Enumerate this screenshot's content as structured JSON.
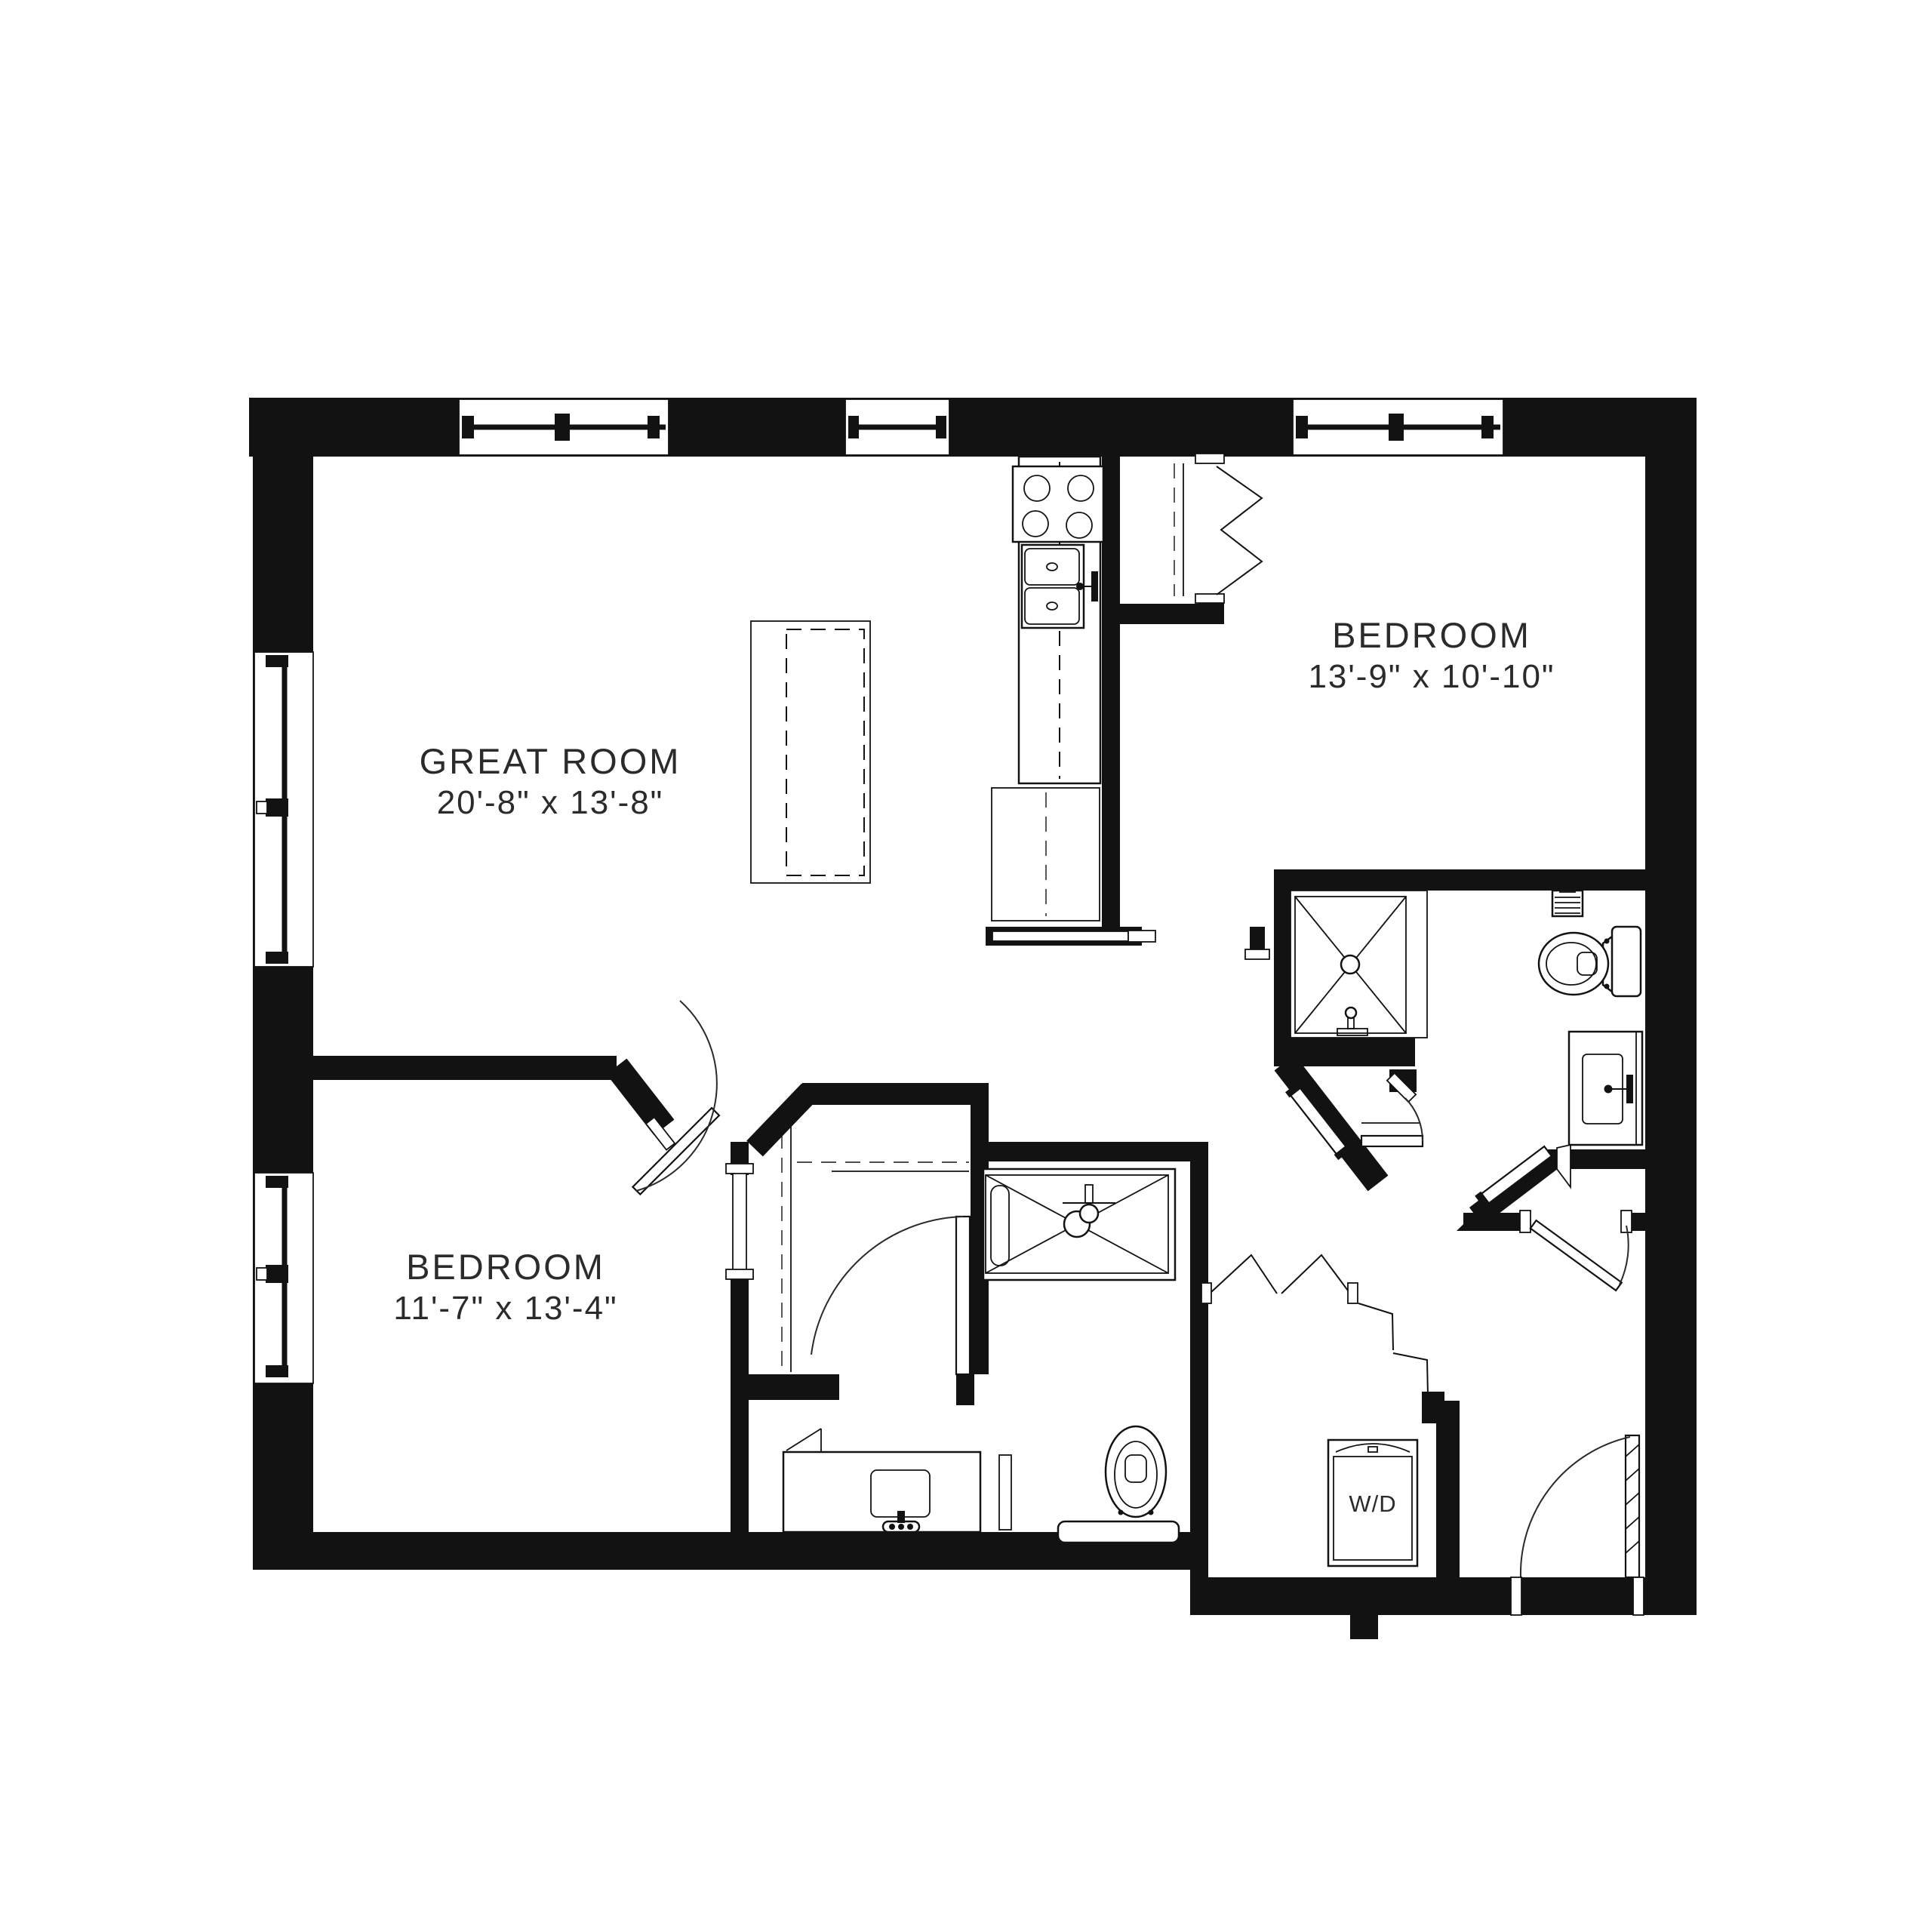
{
  "document": {
    "type": "apartment floor plan",
    "style": "black and white architectural drawing",
    "background_color": "#ffffff",
    "wall_color": "#121212",
    "line_color": "#2a2a2a",
    "text_color": "#2b2b2b"
  },
  "labels": {
    "great_room": {
      "name": "GREAT ROOM",
      "dims": "20'-8\" x 13'-8\""
    },
    "bedroom_right": {
      "name": "BEDROOM",
      "dims": "13'-9\" x 10'-10\""
    },
    "bedroom_left": {
      "name": "BEDROOM",
      "dims": "11'-7\" x 13'-4\""
    },
    "laundry": {
      "name": "W/D"
    }
  },
  "rooms": [
    {
      "label": "GREAT ROOM",
      "dimensions": "20'-8\" x 13'-8\"",
      "position": "top-left"
    },
    {
      "label": "BEDROOM",
      "dimensions": "13'-9\" x 10'-10\"",
      "position": "top-right"
    },
    {
      "label": "BEDROOM",
      "dimensions": "11'-7\" x 13'-4\"",
      "position": "bottom-left"
    },
    {
      "label": "",
      "dimensions": "",
      "position": "kitchen along center top, open to great room"
    },
    {
      "label": "",
      "dimensions": "",
      "position": "bathroom with shower right-middle"
    },
    {
      "label": "",
      "dimensions": "",
      "position": "bathroom with tub center-bottom"
    },
    {
      "label": "W/D",
      "dimensions": "",
      "position": "laundry closet bottom-right entry foyer"
    }
  ],
  "fixtures": [
    "cooktop-4-burners",
    "double-kitchen-sink",
    "kitchen-island-dashed",
    "refrigerator",
    "walk-in-shower-x",
    "toilet",
    "bathroom-vanity-sink",
    "wall-vent-grille",
    "bathtub-x",
    "second-toilet",
    "second-vanity-sink",
    "washer-dryer-unit"
  ],
  "openings": [
    "three-top-windows",
    "two-left-windows",
    "bifold-closet-doors-bedroom-right",
    "bifold-closet-doors-laundry",
    "pocket-door-kitchen-hall",
    "angled-pocket-door-bath",
    "swing-doors-bedrooms",
    "entry-door-bottom-right"
  ]
}
